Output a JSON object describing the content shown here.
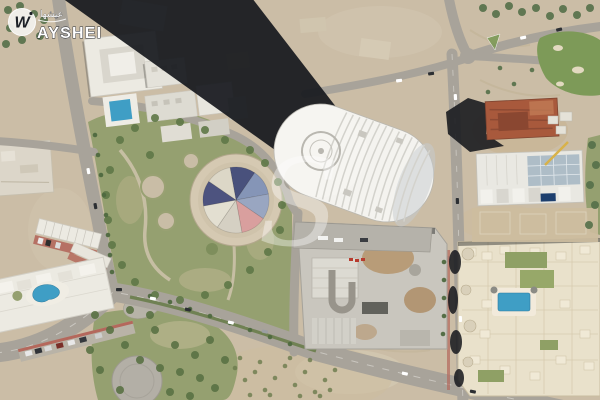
{
  "brand": {
    "monogram": "W",
    "arabic_name": "عيشها",
    "name": "AYSHEI",
    "watermark_letter": "S"
  },
  "colors": {
    "sand": "#cbbda6",
    "sand_light": "#dbd1bd",
    "sand_scrub": "#c8b38e",
    "gravel": "#dcd6c9",
    "road": "#a8a39a",
    "median_green": "#6d7f4f",
    "shadow": "#16181d",
    "park": "#95a070",
    "park_dark": "#7e8e5c",
    "tree": "#5a7244",
    "plaza": "#b3afa6",
    "tower": "#f4f3ef",
    "tower_glass": "#c6cbd0",
    "pool": "#3f9ec5",
    "pool_navy": "#1d3f6e",
    "building_white": "#eceae2",
    "building_gray": "#c9c6be",
    "building_cream": "#e9e1cb",
    "red_building": "#a8593c",
    "parking_red": "#b4685c",
    "golf_green": "#7d9a58",
    "logo_badge": "#f2f1ec",
    "logo_glyph": "#1c2026",
    "tent": [
      "#49517c",
      "#8595b7",
      "#99a6c1",
      "#d99f9e",
      "#d5d0c3",
      "#e3dfd1",
      "#4d537f",
      "#dcd7c7"
    ]
  }
}
